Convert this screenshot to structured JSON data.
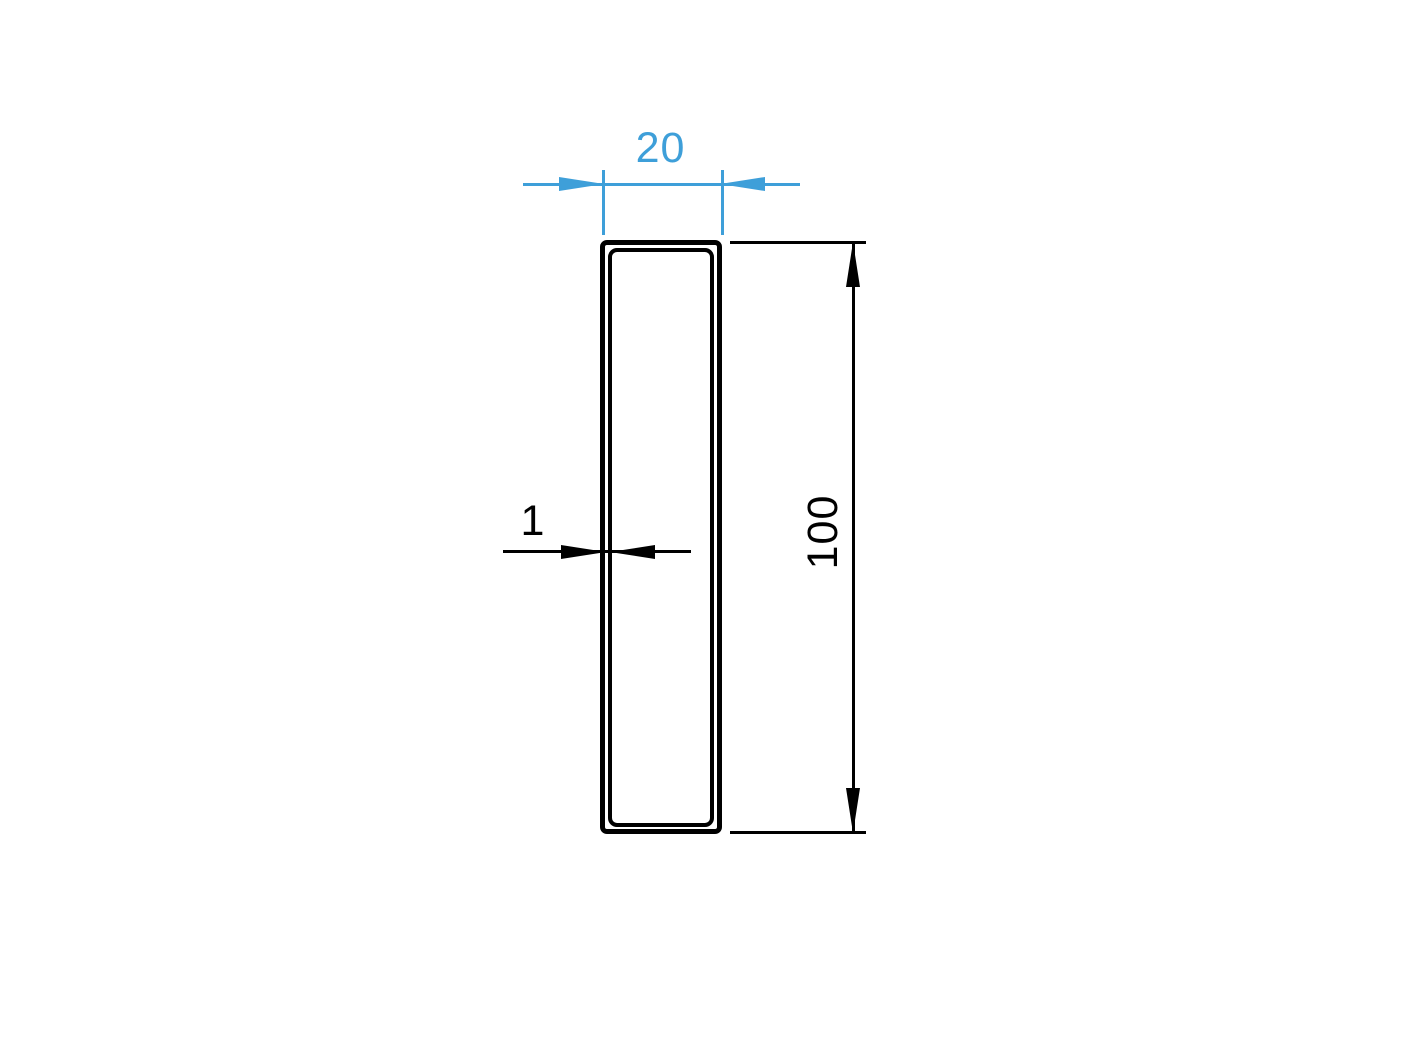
{
  "drawing": {
    "colors": {
      "dimension_accent_blue": "#3e9fd9",
      "line_black": "#000000",
      "background": "#ffffff"
    },
    "dimensions": {
      "width": {
        "label": "20"
      },
      "height": {
        "label": "100"
      },
      "wall_thickness": {
        "label": "1"
      }
    }
  }
}
